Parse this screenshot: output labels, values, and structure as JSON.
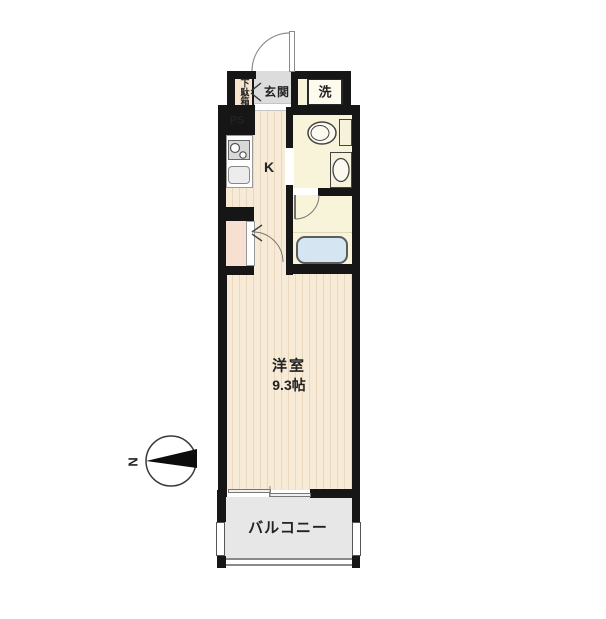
{
  "plan": {
    "labels": {
      "entrance": "玄関",
      "shoe_cabinet": "下駄箱",
      "washer": "洗",
      "pipe_space": "PS",
      "kitchen": "K",
      "room_name": "洋室",
      "room_size": "9.3帖",
      "balcony": "バルコニー",
      "compass_north": "N"
    },
    "colors": {
      "wall": "#161616",
      "flooring": "#f7ead7",
      "flooring-stripe": "#e9d8bf",
      "wet-floor": "#f8f4d9",
      "closet": "#f7e0d1",
      "entrance-floor": "#dcdcdc",
      "balcony-floor": "#e7e7e7",
      "bathtub": "#d6e5f2",
      "fixture-gray": "#d9d9d9"
    }
  }
}
